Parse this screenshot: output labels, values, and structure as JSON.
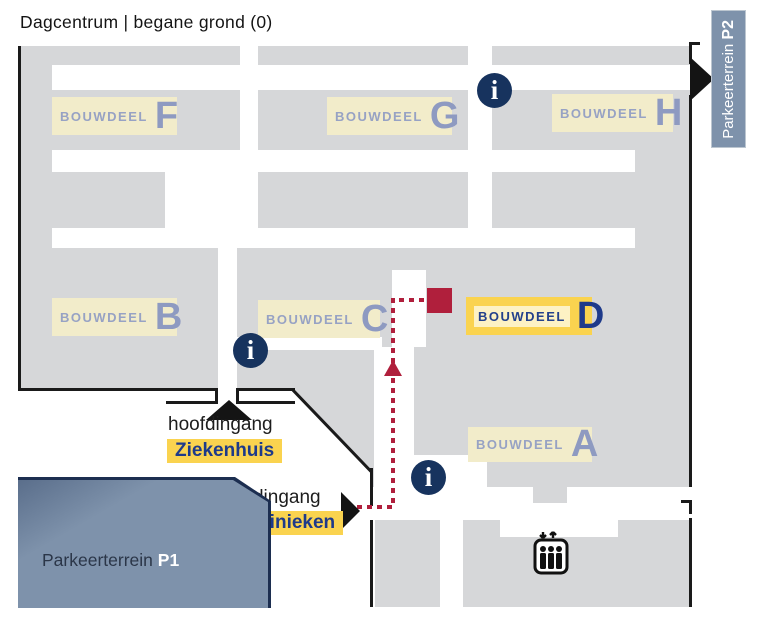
{
  "title": "Dagcentrum | begane grond (0)",
  "buildings": [
    {
      "prefix": "BOUWDEEL",
      "letter": "F",
      "highlighted": false
    },
    {
      "prefix": "BOUWDEEL",
      "letter": "G",
      "highlighted": false
    },
    {
      "prefix": "BOUWDEEL",
      "letter": "H",
      "highlighted": false
    },
    {
      "prefix": "BOUWDEEL",
      "letter": "B",
      "highlighted": false
    },
    {
      "prefix": "BOUWDEEL",
      "letter": "C",
      "highlighted": false
    },
    {
      "prefix": "BOUWDEEL",
      "letter": "D",
      "highlighted": true
    },
    {
      "prefix": "BOUWDEEL",
      "letter": "A",
      "highlighted": false
    }
  ],
  "entrances": {
    "ziekenhuis": {
      "caption": "hoofdingang",
      "name": "Ziekenhuis"
    },
    "poliklinieken": {
      "caption": "hoofdingang",
      "name": "Poliklinieken"
    }
  },
  "parking": {
    "p1": {
      "label": "Parkeerterrein",
      "code": "P1"
    },
    "p2": {
      "label": "Parkeerterrein",
      "code": "P2"
    }
  },
  "info_point": {
    "glyph": "i"
  },
  "colors": {
    "building_gray": "#d6d7d9",
    "label_cream": "#f2ecca",
    "highlight_yellow": "#fad34f",
    "navy": "#17335e",
    "route_red": "#b01f3c",
    "parking_blue": "#7e92ab",
    "letter_blue": "#8e9ac1"
  }
}
